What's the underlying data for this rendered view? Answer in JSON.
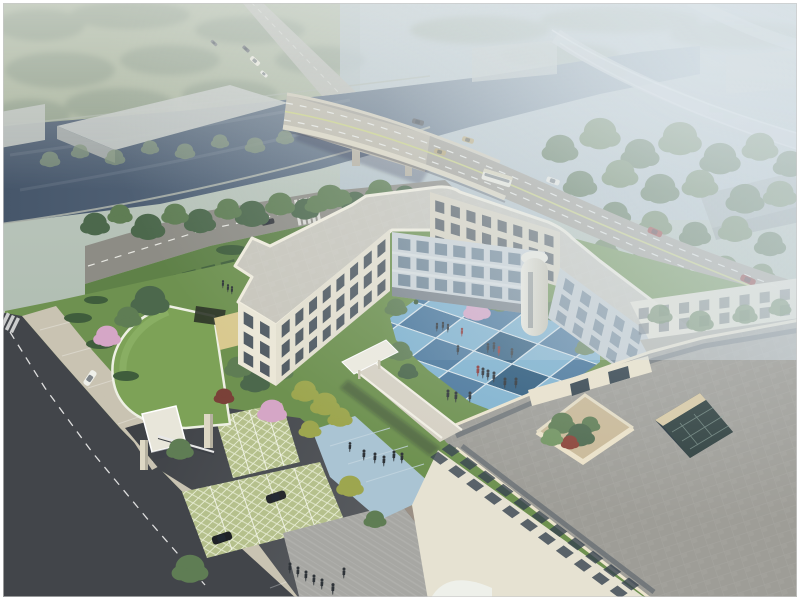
{
  "scene": {
    "description": "Aerial architectural rendering: cream three-storey campus building enclosing a blue checkerboard courtyard with small figures, entrance gatehouse with curved green roof, grass-grid parking with dark SUVs, street with crosswalk and white van, riverside boulevard and bridge over a canal with bus and cars, hazy trees, warehouses and elevated ramp in the distance",
    "palette": {
      "haze_top": "#c3ccc4",
      "haze_right": "#b6c3cd",
      "field_far": "#a7b29a",
      "tree_far": "#8b9a85",
      "river_dark": "#46566a",
      "river_light": "#94a7b6",
      "bank_line": "#b7bbb0",
      "road_main": "#a29e94",
      "bridge_deck": "#bcb6a5",
      "parapet": "#dbd4bf",
      "lane_white": "#e9e9e3",
      "lane_yellow": "#c9cf7e",
      "road_local": "#8d8c85",
      "street": "#42454a",
      "driveway": "#474a4f",
      "ramp": "#c8cfd4",
      "warehouse": "#b3bab6",
      "tree_dark": "#4c684c",
      "tree_mid": "#5f7d54",
      "tree_light": "#729461",
      "tree_yellow": "#9da64f",
      "blossom": "#d5a6c6",
      "shrub_red": "#7a4138",
      "lawn": "#6e9150",
      "lawn_light": "#82a55e",
      "hedge": "#3f5d3c",
      "grass_roof": "#7da257",
      "grass_grid": "#b5c08c",
      "wall_cream": "#ebe7d7",
      "wall_shade": "#d9d3c1",
      "wall_court": "#cbd2d6",
      "window_dark": "#37434f",
      "roof_light": "#c8c6bc",
      "roof_gray": "#9e9d97",
      "roof_court": "#b0aea4",
      "parapet_cream": "#f0ecdd",
      "slate_band": "#646c72",
      "court_blue1": "#7fb2cf",
      "court_blue2": "#4a779c",
      "court_blue3": "#2d5a7c",
      "plaza_blue": "#aac4d3",
      "plaza_gray": "#a7a7a3",
      "plaza_tan": "#a2968a",
      "atrium_glass": "#2b3c3b",
      "atrium_wall": "#d8c9a4",
      "figure": "#2e3338",
      "suv": "#26292d",
      "bus": "#ece9dc",
      "car_red": "#993733",
      "car_white": "#eceae2",
      "car_tan": "#b29e6a",
      "van_white": "#eff0ea",
      "frame": "#ffffff"
    },
    "inventory": {
      "people_visible": 30,
      "vehicles_visible": 17,
      "trees_visible": 80
    }
  }
}
